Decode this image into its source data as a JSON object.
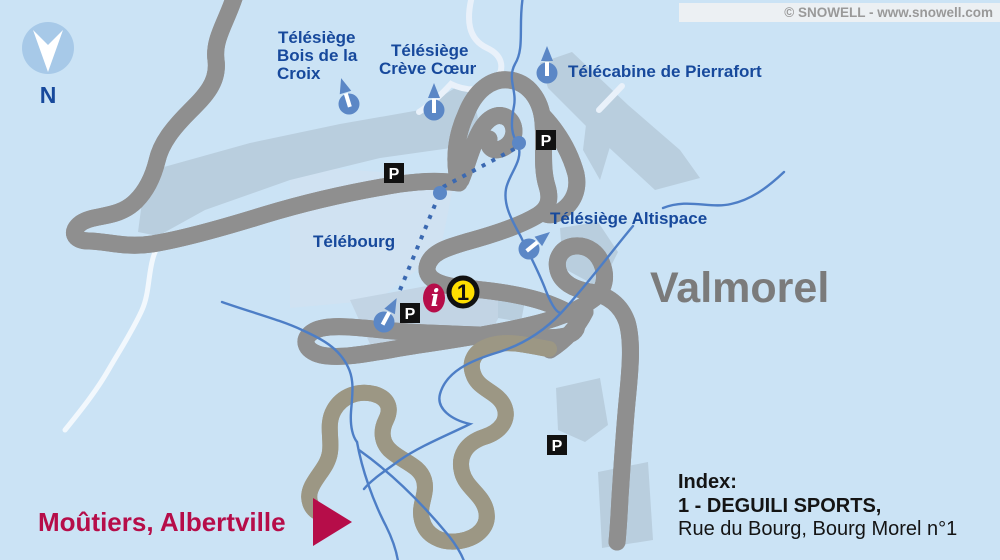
{
  "copyright": "© SNOWELL - www.snowell.com",
  "compass": {
    "north_label": "N"
  },
  "labels": {
    "lift_bois": {
      "line1": "Télésiège",
      "line2": "Bois de la",
      "line3": "Croix"
    },
    "lift_creve": {
      "line1": "Télésiège",
      "line2": "Crève Cœur"
    },
    "lift_pierrafort": "Télécabine de Pierrafort",
    "lift_altispace": "Télésiège Altispace",
    "lift_telebourg": "Télébourg",
    "resort_name": "Valmorel",
    "direction_label": "Moûtiers, Albertville"
  },
  "markers": {
    "parking_letter": "P",
    "info_letter": "i",
    "shop_badge_number": "1"
  },
  "index_panel": {
    "title": "Index:",
    "entry_name": "1 - DEGUILI SPORTS,",
    "entry_address": "Rue du Bourg, Bourg Morel n°1"
  },
  "colors": {
    "background": "#cbe3f5",
    "building_area": "#b9cede",
    "road_outline": "#8f8f8f",
    "road_fill": "#ffffff",
    "secondary_road_fill": "#f6ecc5",
    "water_blue": "#4d7ec6",
    "lift_blue": "#5b87c6",
    "label_blue": "#17499c",
    "resort_gray": "#7b7b7b",
    "accent_crimson": "#b60d49",
    "badge_yellow": "#ffdf00",
    "copyright_gray": "#999999"
  }
}
